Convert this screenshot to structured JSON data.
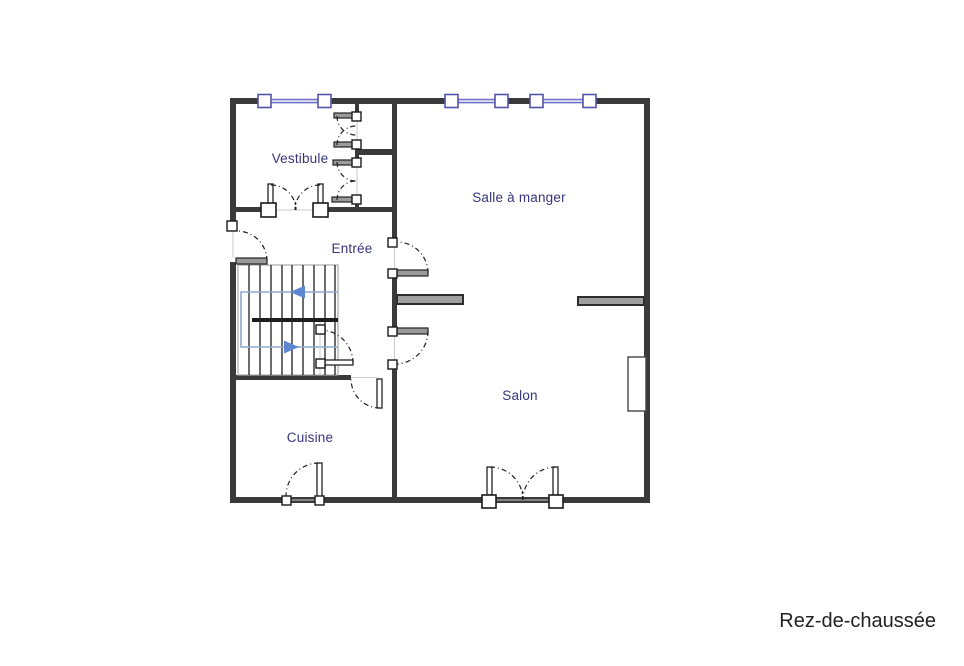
{
  "floor": {
    "title": "Rez-de-chaussée"
  },
  "rooms": [
    {
      "name": "Vestibule"
    },
    {
      "name": "Salle à manger"
    },
    {
      "name": "Entrée"
    },
    {
      "name": "Salon"
    },
    {
      "name": "Cuisine"
    }
  ],
  "features": {
    "windows_top_wall": 3,
    "staircase_flights": 2,
    "french_door": "double door to Salon",
    "fireplace": "right wall of Salon"
  },
  "colors": {
    "background": "#ffffff",
    "wall": "#3a3a3a",
    "label_text": "#35357e",
    "window_accent": "#7070c8",
    "stair_arrow": "#5d87d1",
    "title_text": "#222222"
  }
}
